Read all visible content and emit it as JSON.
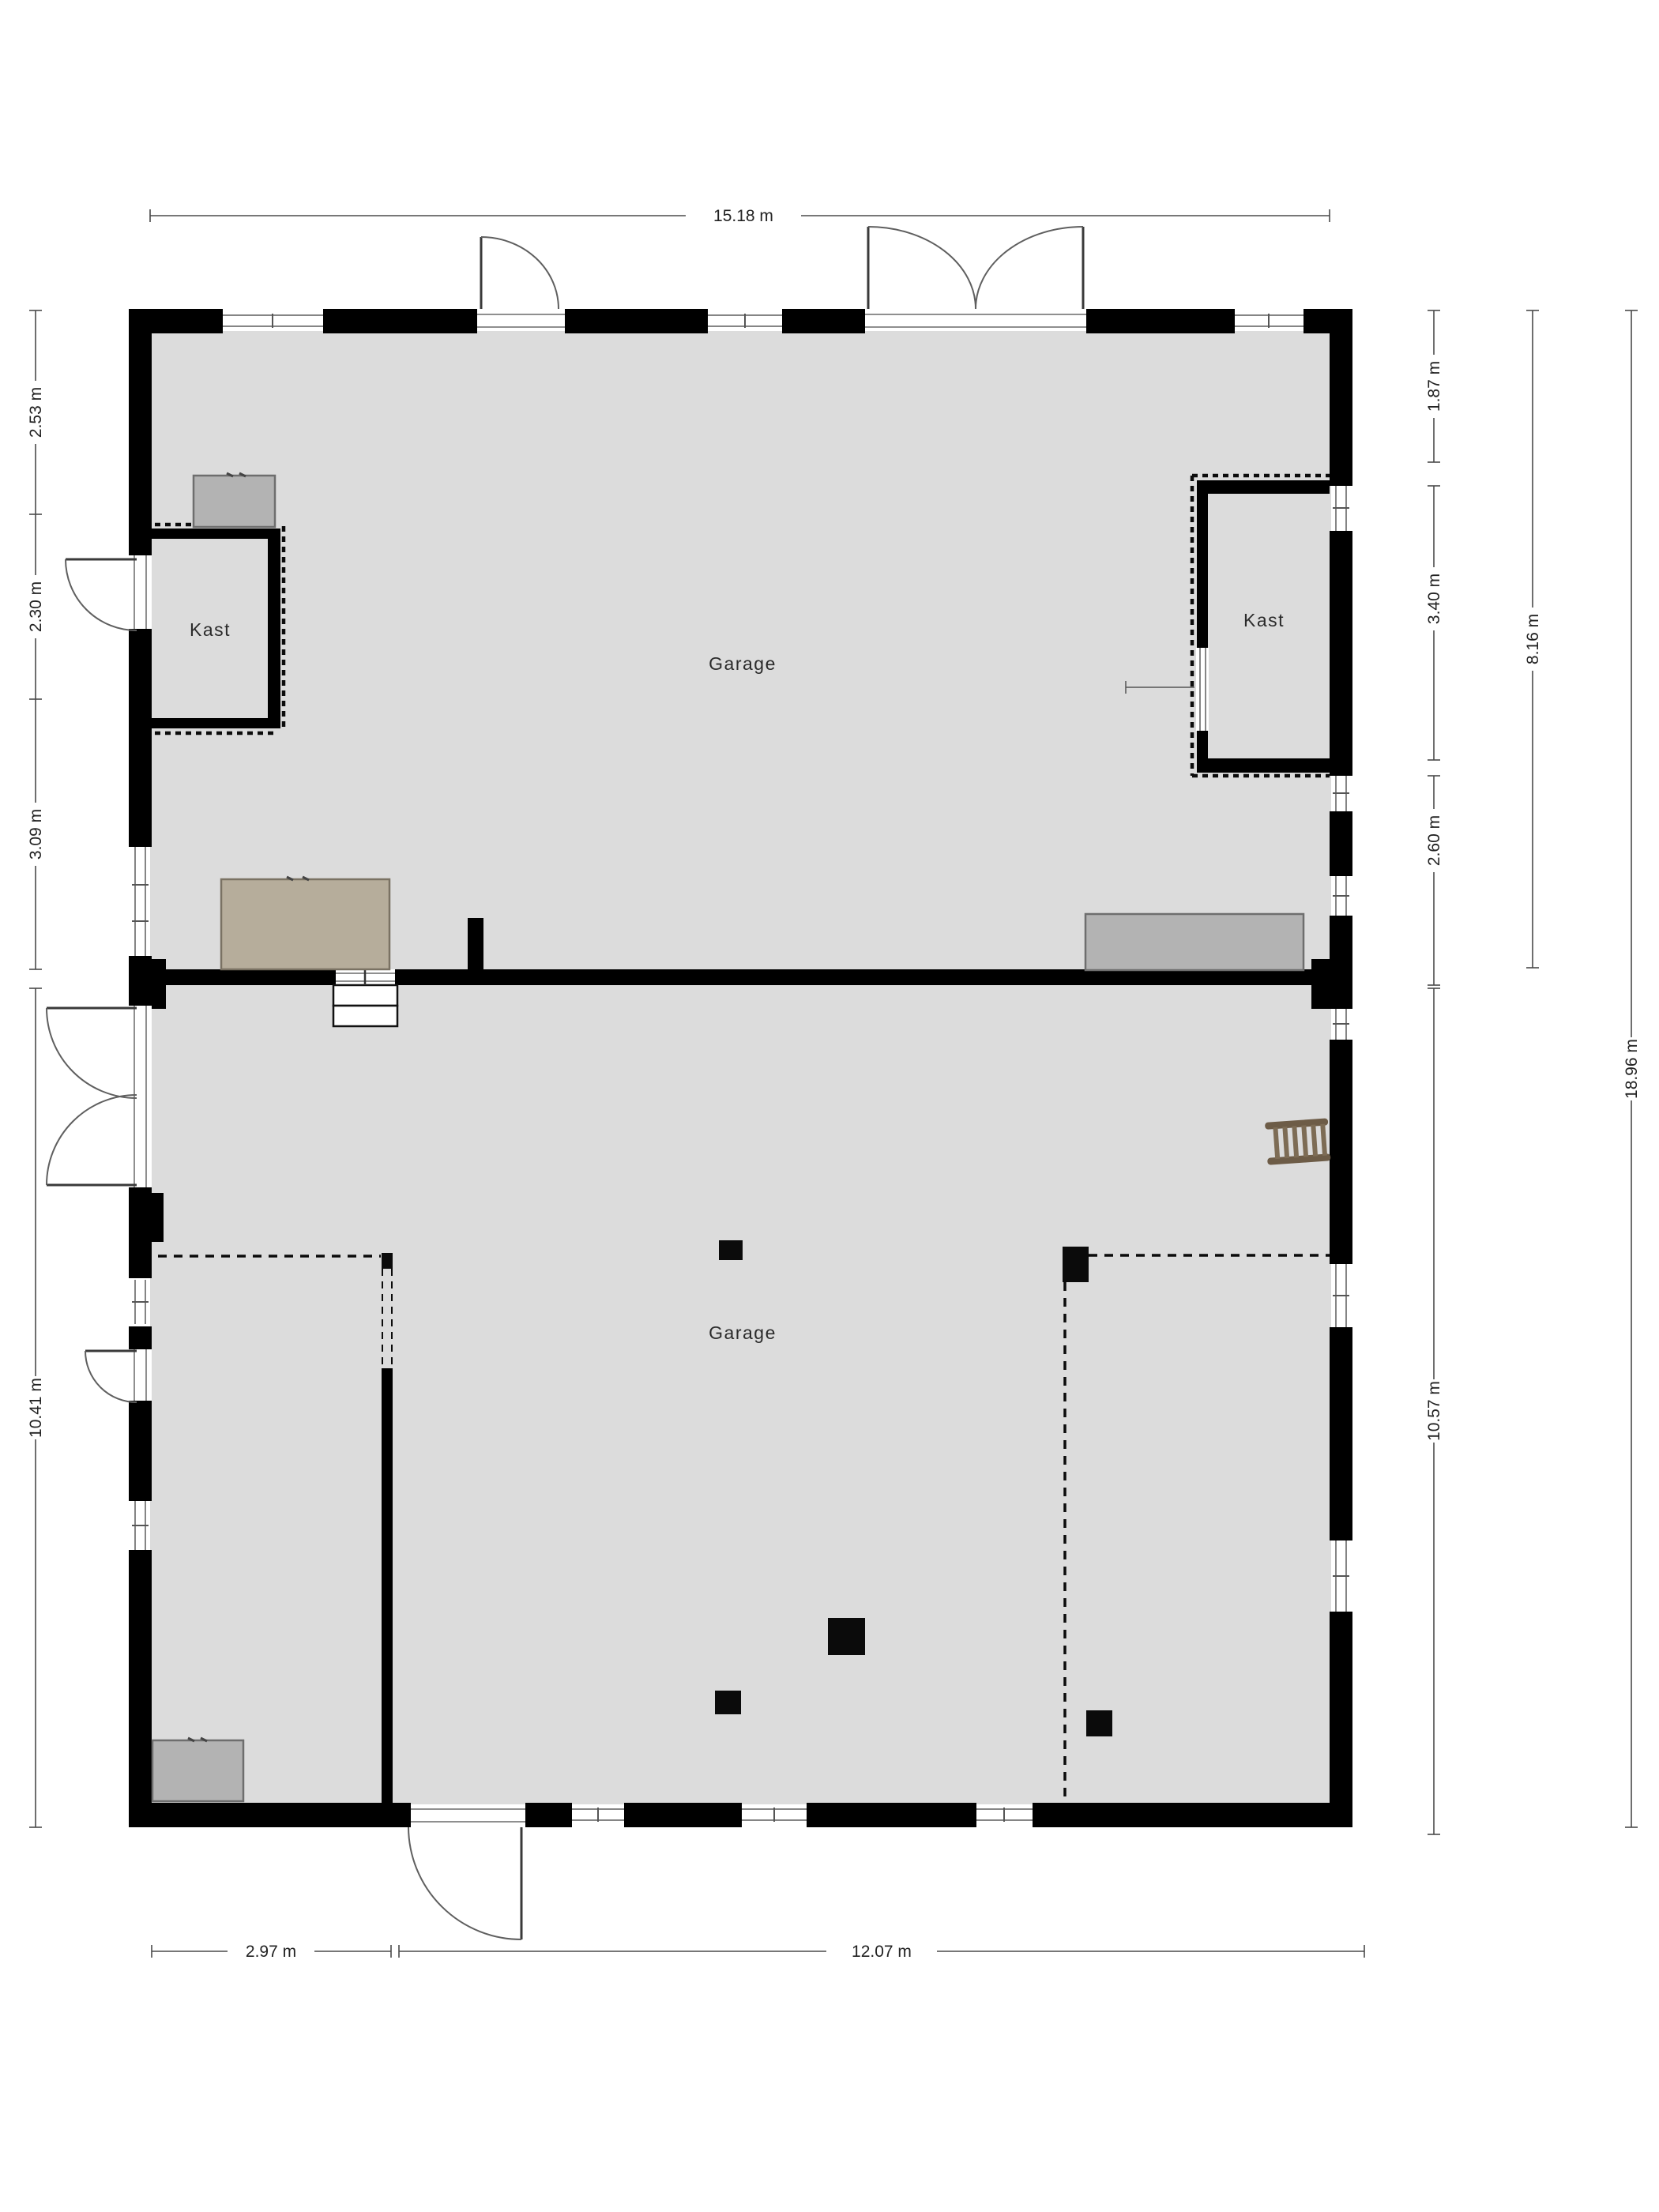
{
  "rooms": {
    "garage_top": "Garage",
    "garage_bottom": "Garage",
    "kast_left": "Kast",
    "kast_right": "Kast"
  },
  "dimensions": {
    "top": "15.18 m",
    "left_2_53": "2.53 m",
    "left_2_30": "2.30 m",
    "left_3_09": "3.09 m",
    "left_10_41": "10.41 m",
    "right_1_87": "1.87 m",
    "right_3_40": "3.40 m",
    "right_2_60": "2.60 m",
    "right_10_57": "10.57 m",
    "far_8_16": "8.16 m",
    "far_18_96": "18.96 m",
    "bottom_2_97": "2.97 m",
    "bottom_12_07": "12.07 m"
  },
  "colors": {
    "wall": "#000000",
    "floor": "#dcdcdc",
    "outside": "#ffffff",
    "furn": "#b3b3b3",
    "bench": "#b6ad9b",
    "ladder": "#6d5c47",
    "dimtext": "#222222"
  }
}
